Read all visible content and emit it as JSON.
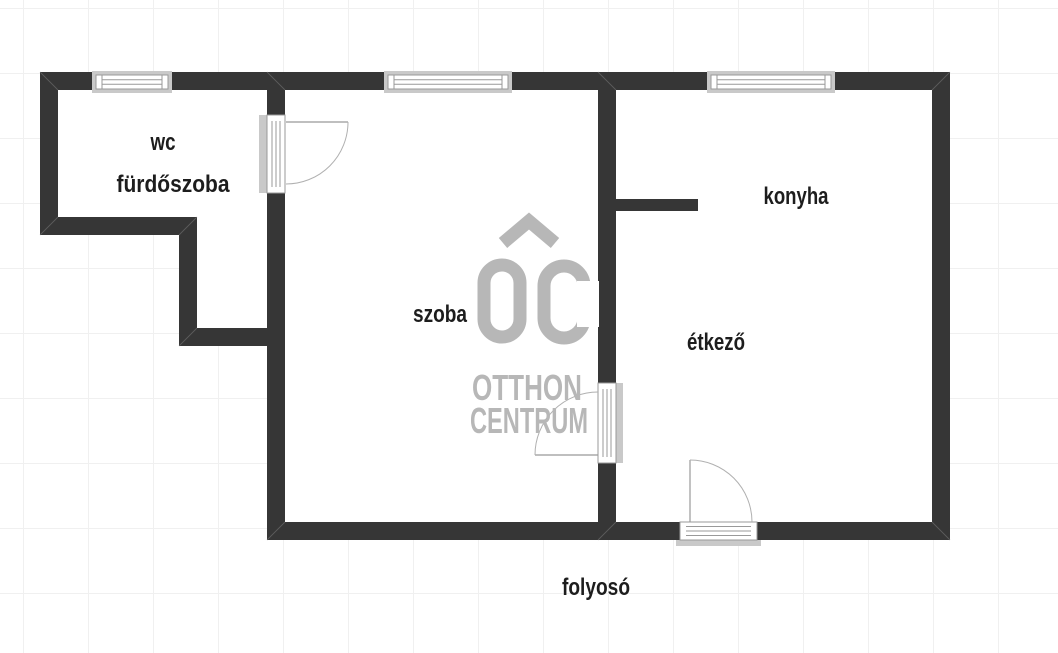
{
  "floorplan": {
    "type": "apartment floor plan",
    "room_labels": {
      "wc": "wc",
      "furdoszoba": "fürdőszoba",
      "szoba": "szoba",
      "konyha": "konyha",
      "etkezo": "étkező",
      "folyoso": "folyosó"
    },
    "watermark": {
      "monogram": "OC",
      "line1": "OTTHON",
      "line2": "CENTRUM"
    },
    "colors": {
      "wall": "#363636",
      "label_text": "#1d1d1d",
      "watermark_gray": "#b7b7b7",
      "window_frame_gray": "#c9c9c9",
      "symbol_line_gray": "#999999",
      "door_arc_gray": "#b0b0b0",
      "grid_line": "#f0f0f0",
      "background": "#ffffff"
    }
  }
}
